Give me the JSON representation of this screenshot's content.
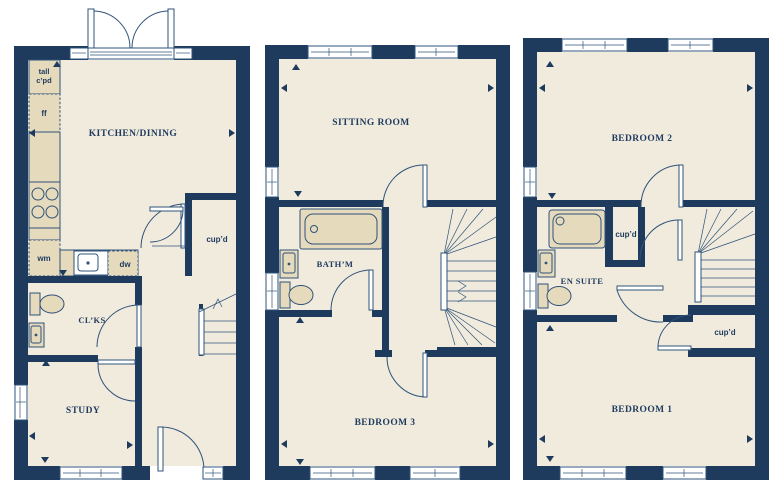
{
  "colors": {
    "wall": "#1e3b5e",
    "floor": "#f1ebde",
    "fixture": "#e6dabd",
    "line": "#2f5379",
    "window": "#ffffff",
    "label": "#1e3b5e",
    "background": "#ffffff"
  },
  "ground_floor": {
    "kitchen_dining": "KITCHEN/DINING",
    "cupboard": "cup’d",
    "cloakroom": "CL’KS",
    "study": "STUDY",
    "tall_cupboard_line1": "tall",
    "tall_cupboard_line2": "c’pd",
    "fridge_freezer": "ff",
    "washing_machine": "wm",
    "dishwasher": "dw"
  },
  "first_floor": {
    "sitting_room": "SITTING ROOM",
    "bathroom": "BATH’M",
    "bedroom3": "BEDROOM 3"
  },
  "second_floor": {
    "bedroom2": "BEDROOM 2",
    "cupboard_landing": "cup’d",
    "en_suite": "EN SUITE",
    "cupboard_bedroom": "cup’d",
    "bedroom1": "BEDROOM 1"
  }
}
